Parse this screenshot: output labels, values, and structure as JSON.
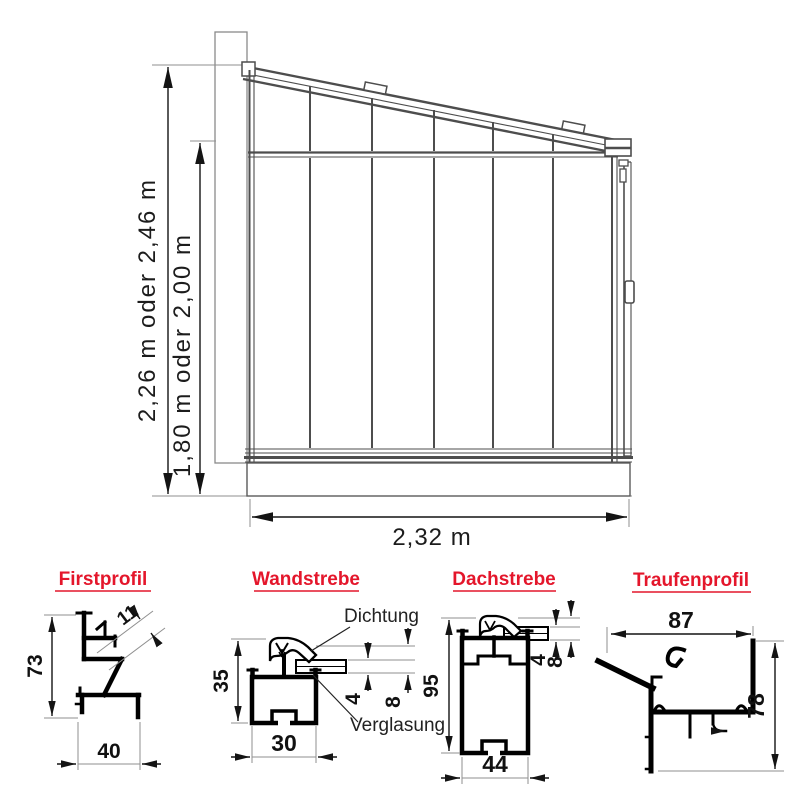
{
  "colors": {
    "accent": "#e4162b",
    "frame_line": "#4d4d4d",
    "dimension": "#141414"
  },
  "main_view": {
    "dim_outer_height": "2,26 m oder 2,46 m",
    "dim_inner_height": "1,80 m oder 2,00 m",
    "dim_width": "2,32 m"
  },
  "profiles": {
    "firstprofil": {
      "title": "Firstprofil",
      "dim_height": "73",
      "dim_width": "40",
      "dim_offset": "11"
    },
    "wandstrebe": {
      "title": "Wandstrebe",
      "dim_height": "35",
      "dim_width": "30",
      "dim_glass": "4",
      "dim_total": "8",
      "label_gasket": "Dichtung",
      "label_glazing": "Verglasung"
    },
    "dachstrebe": {
      "title": "Dachstrebe",
      "dim_height": "95",
      "dim_width": "44",
      "dim_glass": "4",
      "dim_total": "8"
    },
    "traufenprofil": {
      "title": "Traufenprofil",
      "dim_width": "87",
      "dim_height": "78"
    }
  }
}
